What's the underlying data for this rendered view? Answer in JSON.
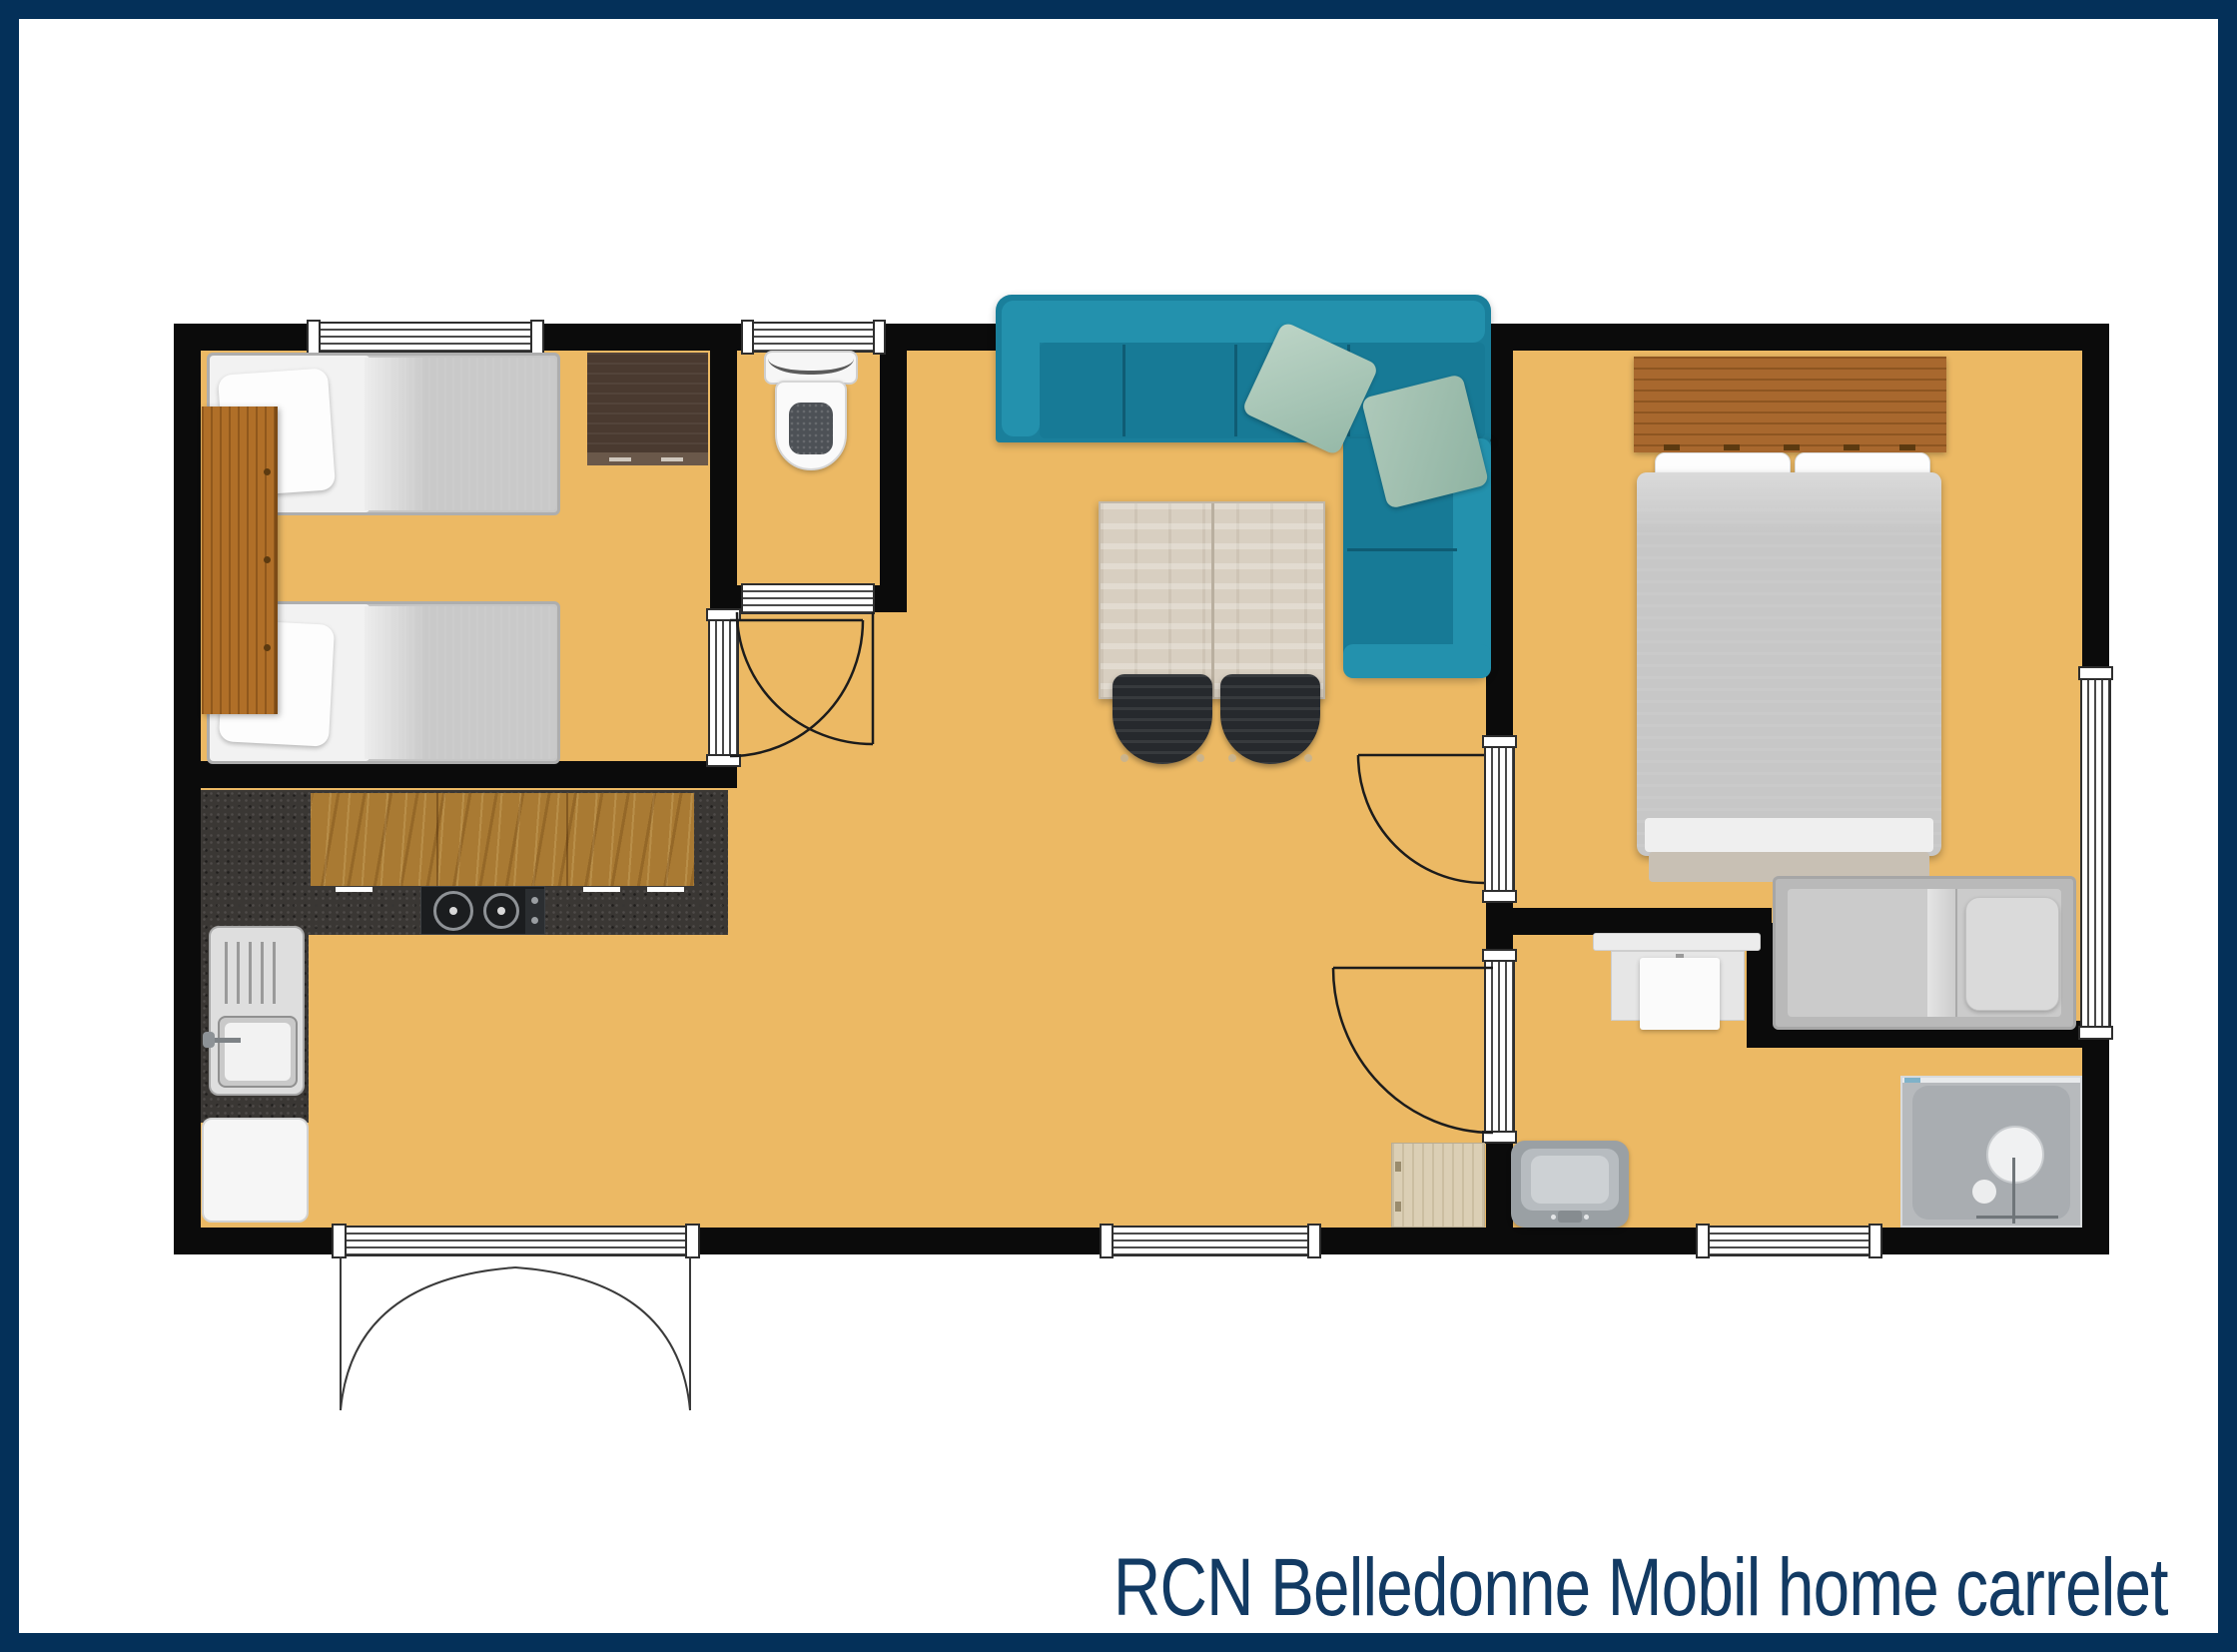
{
  "title": "RCN Belledonne Mobil home carrelet",
  "colors": {
    "frame_border": "#043059",
    "title_text": "#123a63",
    "floor": "#ecb964",
    "walls": "#0b0b0b",
    "sofa_teal": "#1a7f9b",
    "kitchen_granite": "#3a3734",
    "worktop_oak": "#a97a33",
    "headboard_wood": "#a8682e",
    "wardrobe_brown": "#4a3a30"
  }
}
